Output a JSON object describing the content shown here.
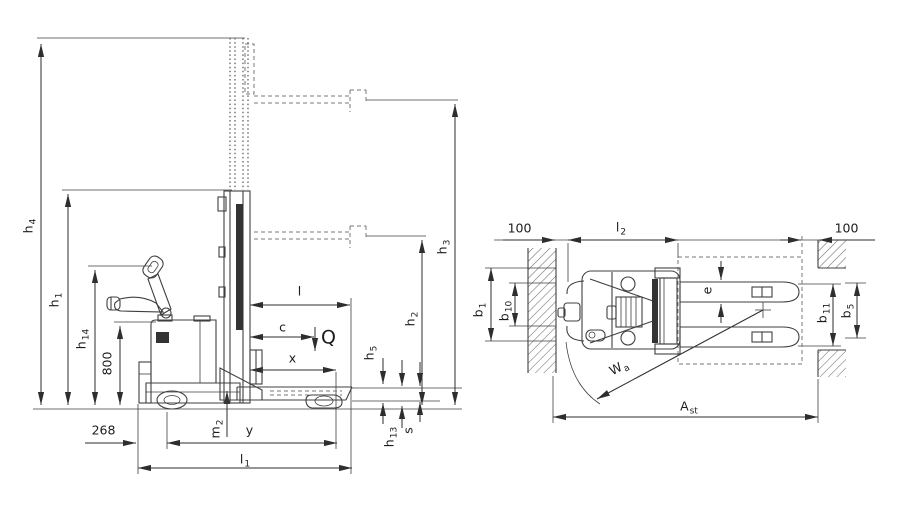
{
  "colors": {
    "background": "#ffffff",
    "line": "#3f3f3f",
    "dim": "#2e2e2e",
    "dark_fill": "#333333",
    "hatch": "#6e6e6e"
  },
  "side_view": {
    "labels": {
      "h4": {
        "text": "h",
        "sub": "4"
      },
      "h1": {
        "text": "h",
        "sub": "1"
      },
      "h14": {
        "text": "h",
        "sub": "14"
      },
      "d800": {
        "text": "800",
        "sub": ""
      },
      "d268": {
        "text": "268",
        "sub": ""
      },
      "m2": {
        "text": "m",
        "sub": "2"
      },
      "y": {
        "text": "y",
        "sub": ""
      },
      "l1": {
        "text": "l",
        "sub": "1"
      },
      "l": {
        "text": "l",
        "sub": ""
      },
      "c": {
        "text": "c",
        "sub": ""
      },
      "Q": {
        "text": "Q",
        "sub": ""
      },
      "x": {
        "text": "x",
        "sub": ""
      },
      "h5": {
        "text": "h",
        "sub": "5"
      },
      "h2": {
        "text": "h",
        "sub": "2"
      },
      "h3": {
        "text": "h",
        "sub": "3"
      },
      "h13": {
        "text": "h",
        "sub": "13"
      },
      "s": {
        "text": "s",
        "sub": ""
      }
    }
  },
  "top_view": {
    "labels": {
      "d100l": {
        "text": "100",
        "sub": ""
      },
      "l2": {
        "text": "l",
        "sub": "2"
      },
      "d100r": {
        "text": "100",
        "sub": ""
      },
      "b1": {
        "text": "b",
        "sub": "1"
      },
      "b10": {
        "text": "b",
        "sub": "10"
      },
      "e": {
        "text": "e",
        "sub": ""
      },
      "b11": {
        "text": "b",
        "sub": "11"
      },
      "b5": {
        "text": "b",
        "sub": "5"
      },
      "wa": {
        "text": "W",
        "sub": "a"
      },
      "ast": {
        "text": "A",
        "sub": "st"
      }
    }
  }
}
